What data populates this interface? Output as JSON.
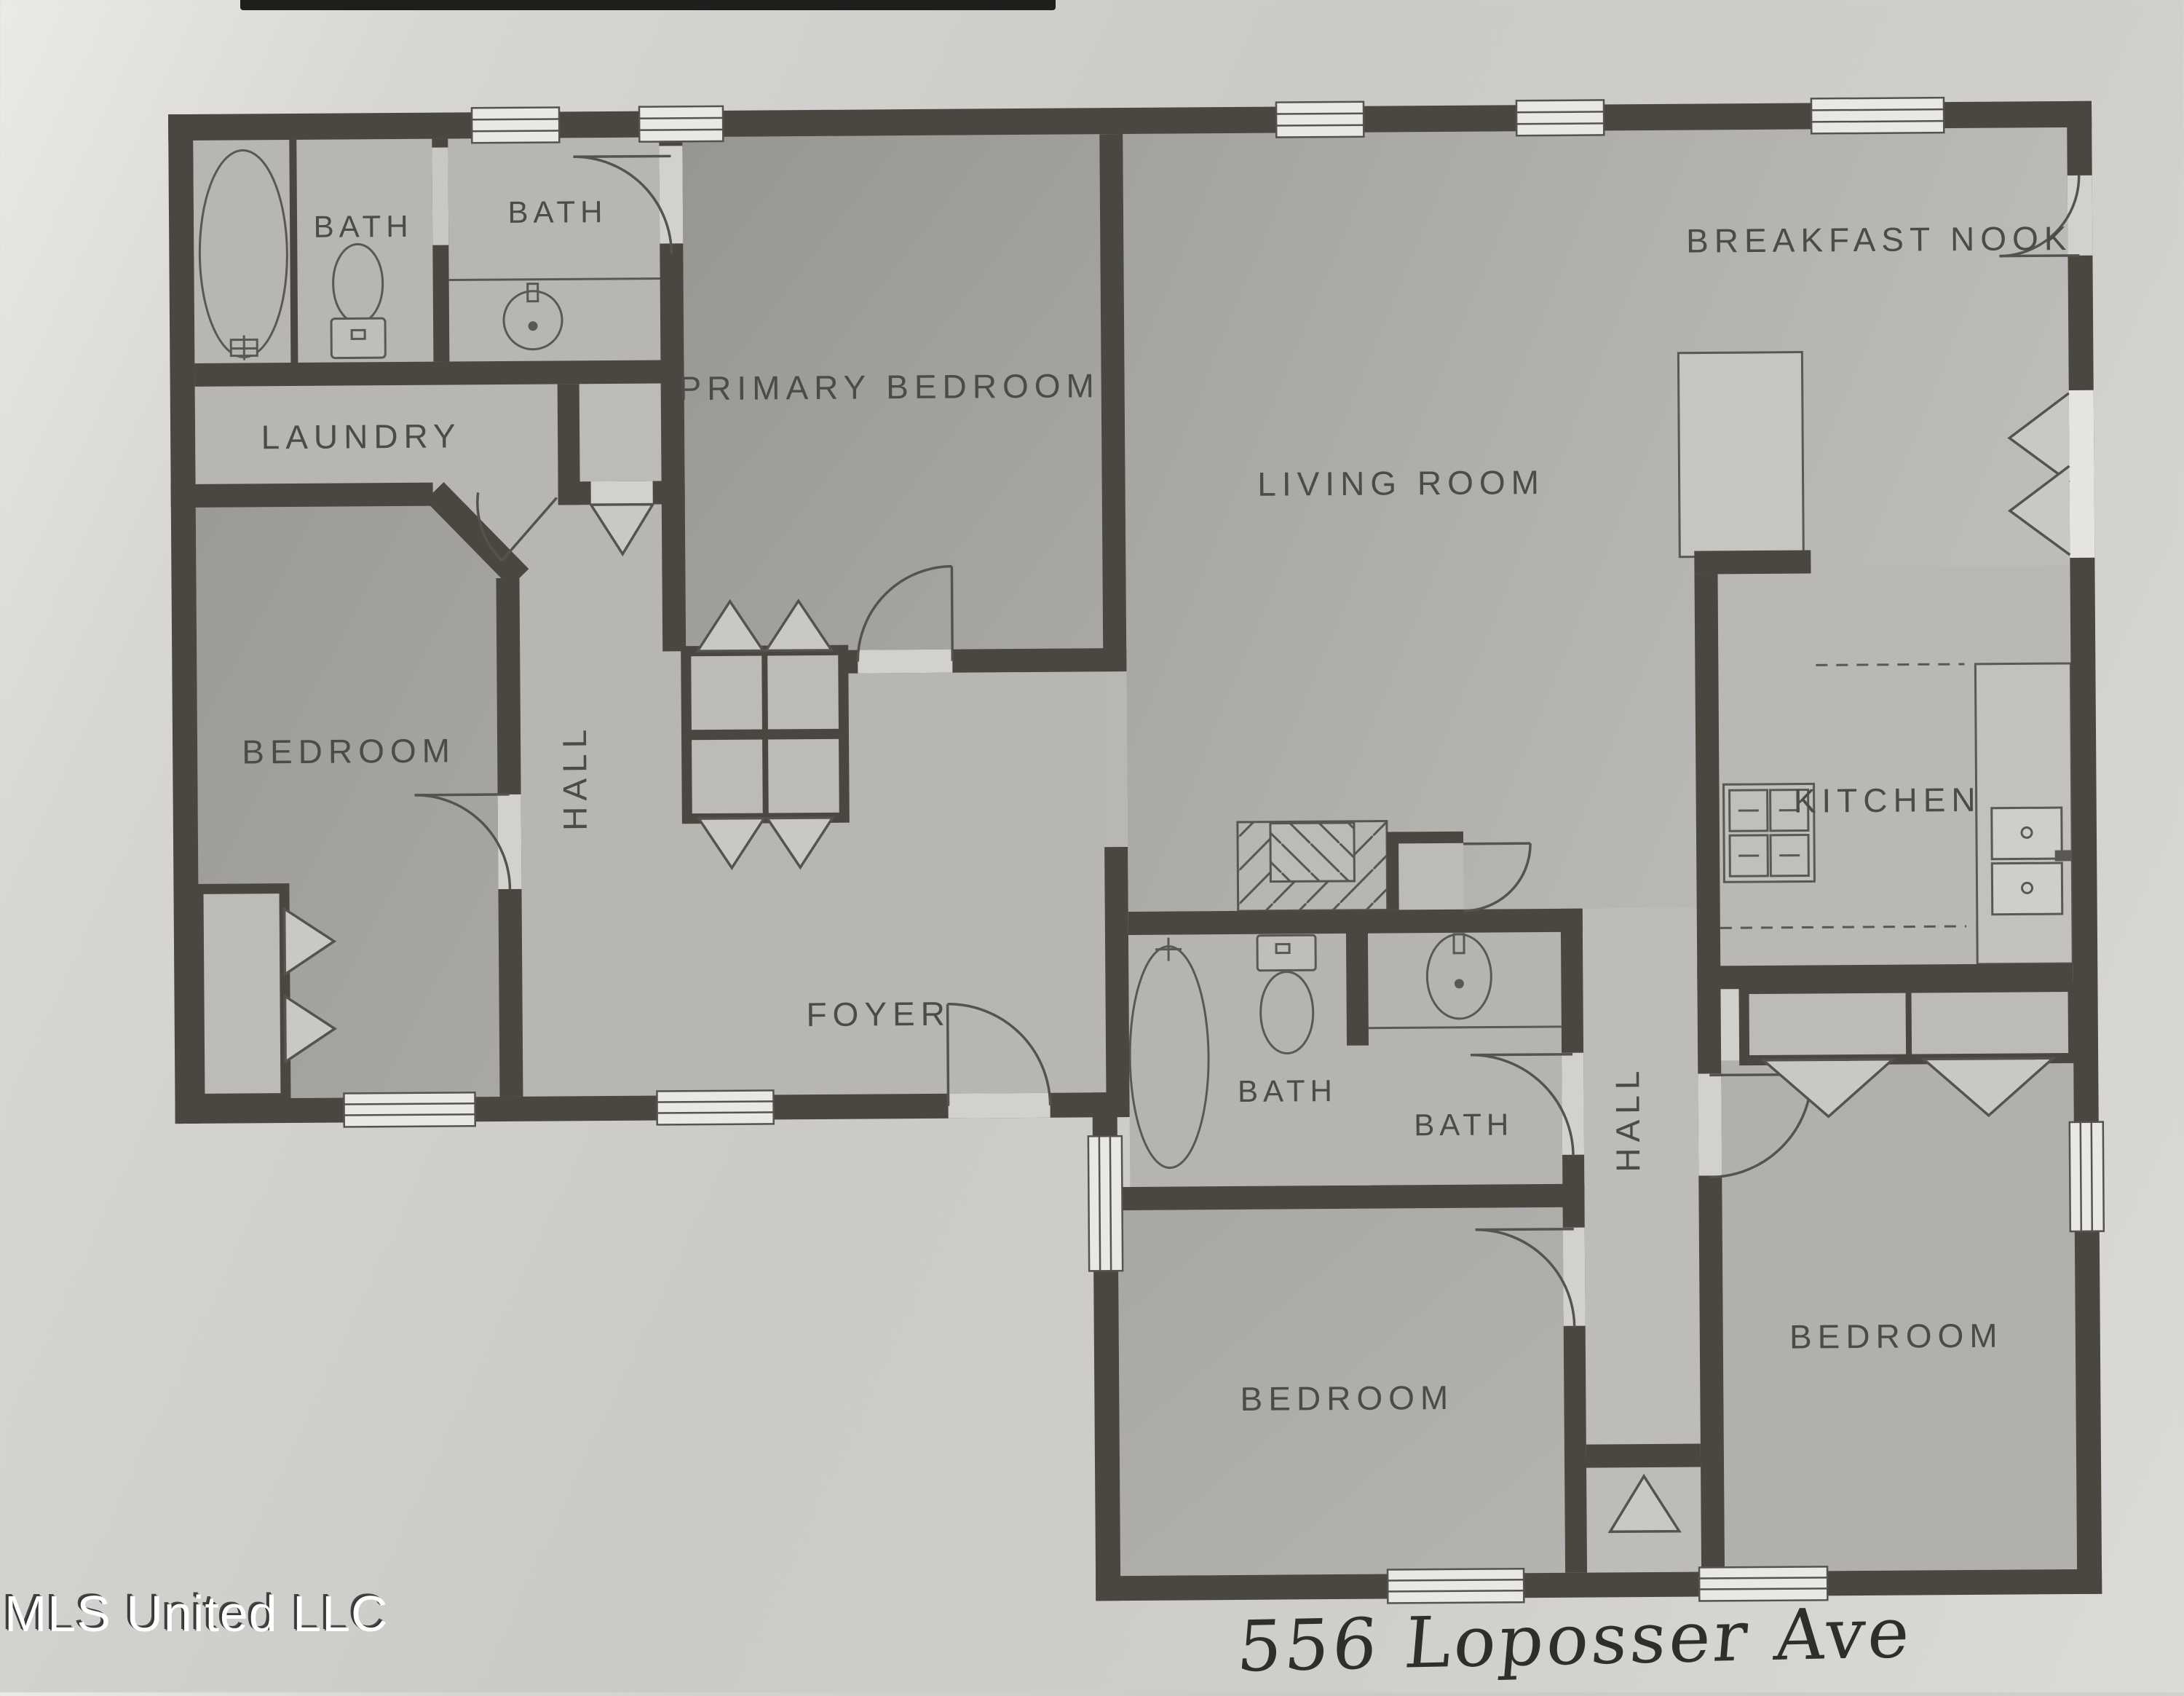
{
  "document": {
    "kind": "scanned floor plan photo",
    "colors": {
      "walls": "#4a4741",
      "paper": "#cfcecb",
      "label_ink": "#4c4b47",
      "handwriting_ink": "#2f2e2c",
      "watermark": "#ffffff"
    }
  },
  "floor_plan": {
    "rooms": {
      "bath_left_1": {
        "label": "BATH"
      },
      "bath_left_2": {
        "label": "BATH"
      },
      "laundry": {
        "label": "LAUNDRY"
      },
      "primary_bedroom": {
        "label": "PRIMARY BEDROOM"
      },
      "living_room": {
        "label": "LIVING ROOM"
      },
      "breakfast_nook": {
        "label": "BREAKFAST NOOK"
      },
      "bedroom_left": {
        "label": "BEDROOM"
      },
      "hall_left": {
        "label": "HALL"
      },
      "foyer": {
        "label": "FOYER"
      },
      "kitchen": {
        "label": "KITCHEN"
      },
      "bath_mid_1": {
        "label": "BATH"
      },
      "bath_mid_2": {
        "label": "BATH"
      },
      "hall_right": {
        "label": "HALL"
      },
      "bedroom_bottom_middle": {
        "label": "BEDROOM"
      },
      "bedroom_bottom_right": {
        "label": "BEDROOM"
      }
    },
    "fixtures": [
      "bathtub-icon",
      "toilet-icon",
      "sink-icon",
      "stove-icon",
      "kitchen-sink-icon",
      "kitchen-island",
      "closet-bifold-doors",
      "door-swing",
      "window",
      "hatched-storage"
    ]
  },
  "watermark": {
    "text": "MLS United LLC"
  },
  "annotation": {
    "handwritten_address": "556 Loposser Ave"
  }
}
